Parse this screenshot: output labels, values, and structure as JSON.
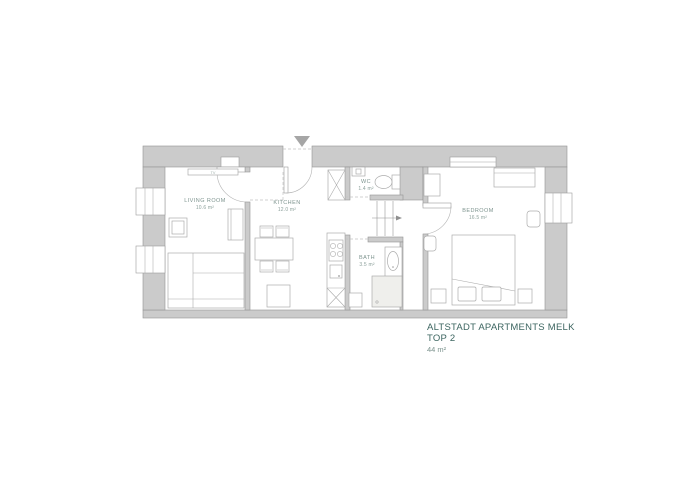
{
  "title_block": {
    "line1": "ALTSTADT APARTMENTS MELK",
    "line2": "TOP 2",
    "area": "44 m²"
  },
  "rooms": {
    "living": {
      "name": "LIVING ROOM",
      "area": "10.6 m²"
    },
    "kitchen": {
      "name": "KITCHEN",
      "area": "12.0 m²"
    },
    "wc": {
      "name": "WC",
      "area": "1.4 m²"
    },
    "bath": {
      "name": "BATH",
      "area": "3.5 m²"
    },
    "bedroom": {
      "name": "BEDROOM",
      "area": "16.5 m²"
    }
  },
  "furniture": {
    "tv_label": "TV"
  },
  "colors": {
    "wall_fill": "#cbcbcb",
    "wall_line": "#949494",
    "furniture_line": "#acacac",
    "room_label": "#7e948f",
    "title_text": "#3c6560",
    "area_text": "#7c938e",
    "entrance_marker": "#a6a6a6"
  }
}
